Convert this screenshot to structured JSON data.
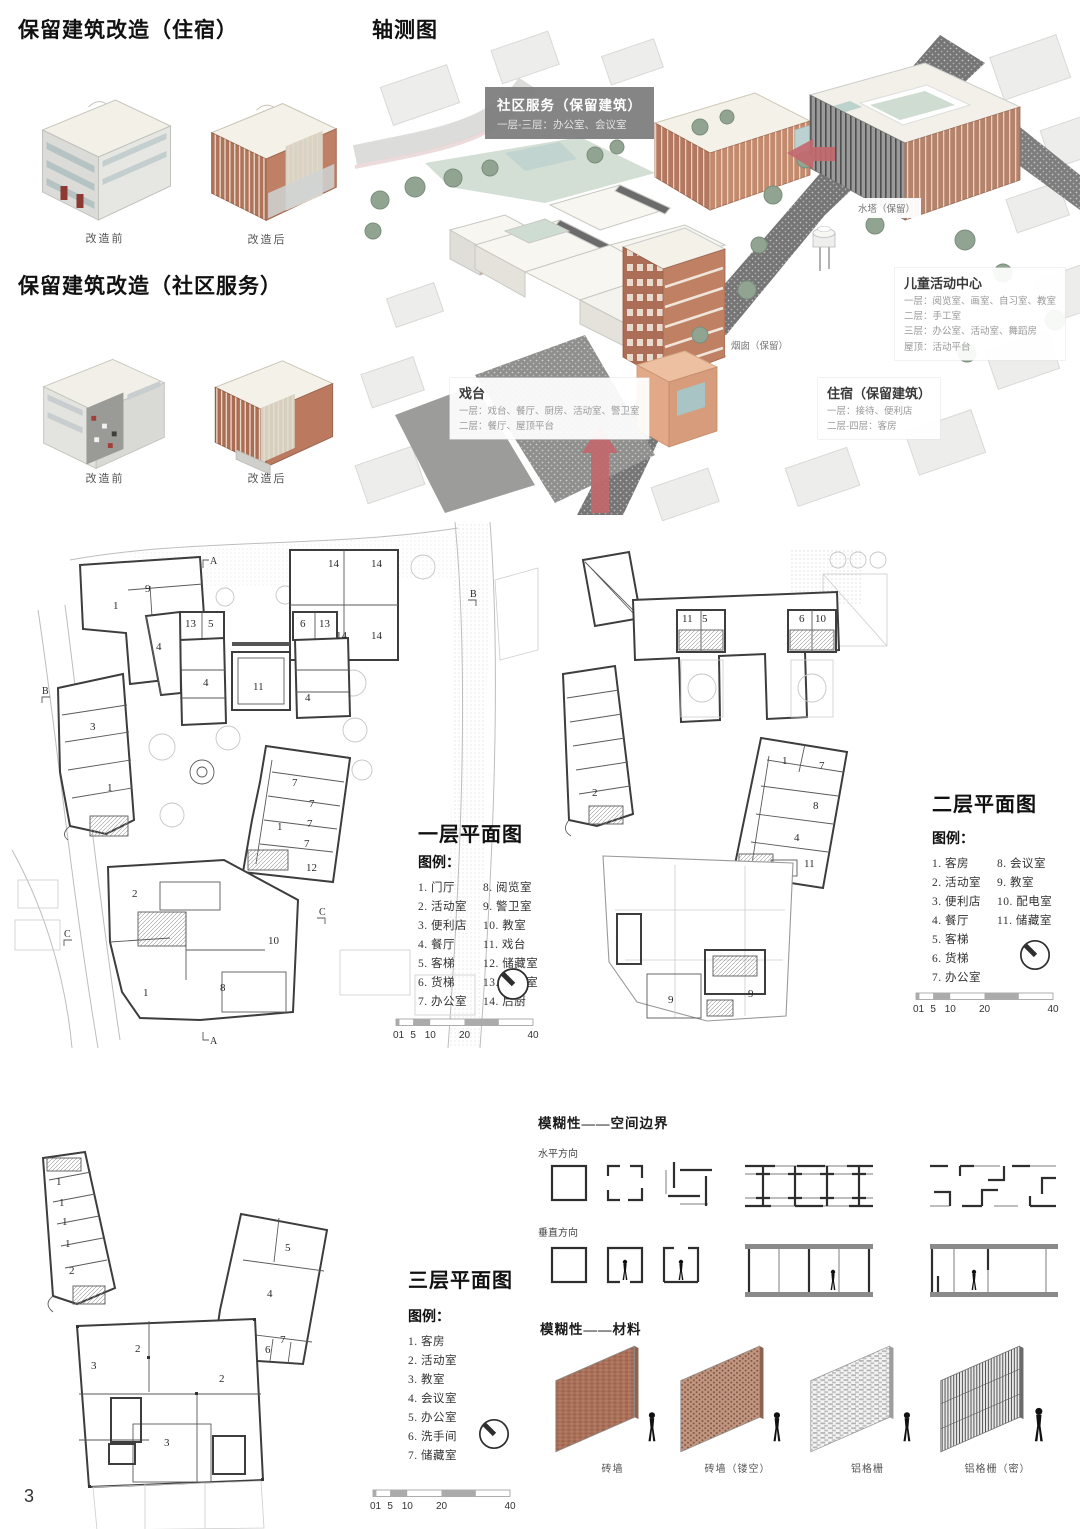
{
  "page_number": "3",
  "reno1": {
    "title": "保留建筑改造（住宿）",
    "before": "改造前",
    "after": "改造后"
  },
  "reno2": {
    "title": "保留建筑改造（社区服务）",
    "before": "改造前",
    "after": "改造后"
  },
  "axon": {
    "title": "轴测图",
    "community_title": "社区服务（保留建筑）",
    "community_sub": "一层-三层：办公室、会议室",
    "water_tower": "水塔（保留）",
    "chimney": "烟囱（保留）",
    "children_title": "儿童活动中心",
    "children_l1": "一层：阅览室、画室、自习室、教室",
    "children_l2": "二层：手工室",
    "children_l3": "三层：办公室、活动室、舞蹈房",
    "children_l4": "屋顶：活动平台",
    "stage_title": "戏台",
    "stage_l1": "一层：戏台、餐厅、厨房、活动室、警卫室",
    "stage_l2": "二层：餐厅、屋顶平台",
    "lodging_title": "住宿（保留建筑）",
    "lodging_l1": "一层：接待、便利店",
    "lodging_l2": "二层-四层：客房"
  },
  "plan1": {
    "title": "一层平面图",
    "legend_title": "图例：",
    "col1": [
      "1. 门厅",
      "2. 活动室",
      "3. 便利店",
      "4. 餐厅",
      "5. 客梯",
      "6. 货梯",
      "7. 办公室"
    ],
    "col2": [
      "8. 阅览室",
      "9. 警卫室",
      "10. 教室",
      "11. 戏台",
      "12. 储藏室",
      "13. 配电室",
      "14. 后厨"
    ],
    "rooms": [
      "9",
      "1",
      "13",
      "5",
      "6",
      "13",
      "14",
      "14",
      "14",
      "14",
      "4",
      "4",
      "4",
      "11",
      "3",
      "1",
      "7",
      "7",
      "7",
      "7",
      "1",
      "12",
      "2",
      "10",
      "8",
      "1"
    ],
    "sections": [
      "A",
      "B",
      "B",
      "C",
      "C",
      "A"
    ],
    "scale": [
      "01",
      "5",
      "10",
      "20",
      "40"
    ]
  },
  "plan2": {
    "title": "二层平面图",
    "legend_title": "图例：",
    "col1": [
      "1. 客房",
      "2. 活动室",
      "3. 便利店",
      "4. 餐厅",
      "5. 客梯",
      "6. 货梯",
      "7. 办公室"
    ],
    "col2": [
      "8. 会议室",
      "9. 教室",
      "10. 配电室",
      "11. 储藏室"
    ],
    "rooms": [
      "2",
      "11",
      "5",
      "6",
      "10",
      "1",
      "7",
      "8",
      "4",
      "11",
      "9",
      "9"
    ],
    "scale": [
      "01",
      "5",
      "10",
      "20",
      "40"
    ]
  },
  "plan3": {
    "title": "三层平面图",
    "legend_title": "图例：",
    "col1": [
      "1. 客房",
      "2. 活动室",
      "3. 教室",
      "4. 会议室",
      "5. 办公室",
      "6. 洗手间",
      "7. 储藏室"
    ],
    "rooms": [
      "1",
      "1",
      "1",
      "1",
      "2",
      "5",
      "4",
      "7",
      "6",
      "2",
      "3",
      "2",
      "3"
    ],
    "scale": [
      "01",
      "5",
      "10",
      "20",
      "40"
    ]
  },
  "space": {
    "title": "模糊性——空间边界",
    "horizontal": "水平方向",
    "vertical": "垂直方向"
  },
  "material": {
    "title": "模糊性——材料",
    "items": [
      "砖墙",
      "砖墙（镂空）",
      "铝格栅",
      "铝格栅（密）"
    ]
  }
}
